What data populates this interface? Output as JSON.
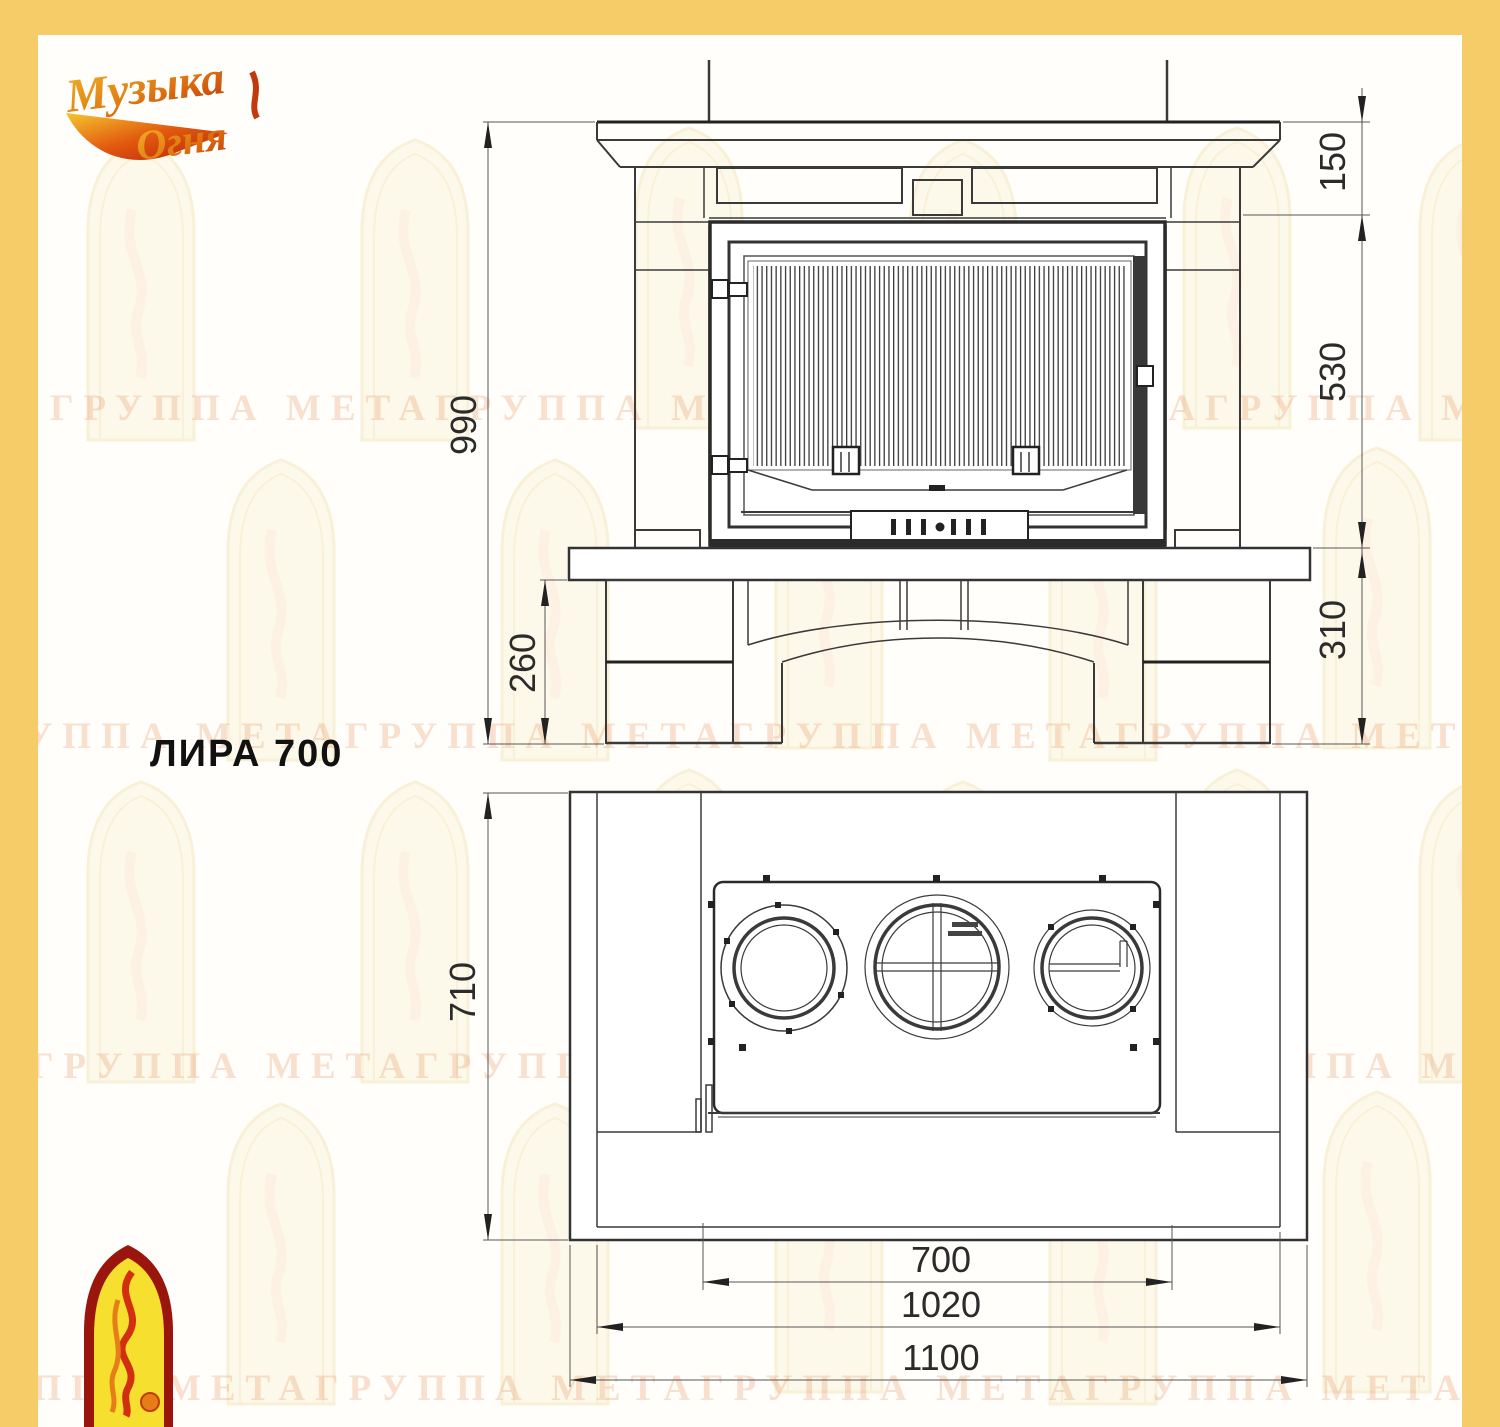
{
  "page": {
    "bg": "#FFFEFB",
    "frame_color": "#F6CC68"
  },
  "logo": {
    "line1": "Музыка",
    "line2": "Огня"
  },
  "title": "ЛИРА 700",
  "watermark": {
    "text": "ГРУППА МЕТАГРУППА МЕТАГРУППА МЕТАГРУППА МЕТА"
  },
  "front_view": {
    "dim_height_total": "990",
    "dim_base_height": "260",
    "dim_top": "150",
    "dim_firebox": "530",
    "dim_bench": "310"
  },
  "plan_view": {
    "dim_depth": "710",
    "dim_firebox_width": "700",
    "dim_inner_width": "1020",
    "dim_overall_width": "1100"
  }
}
